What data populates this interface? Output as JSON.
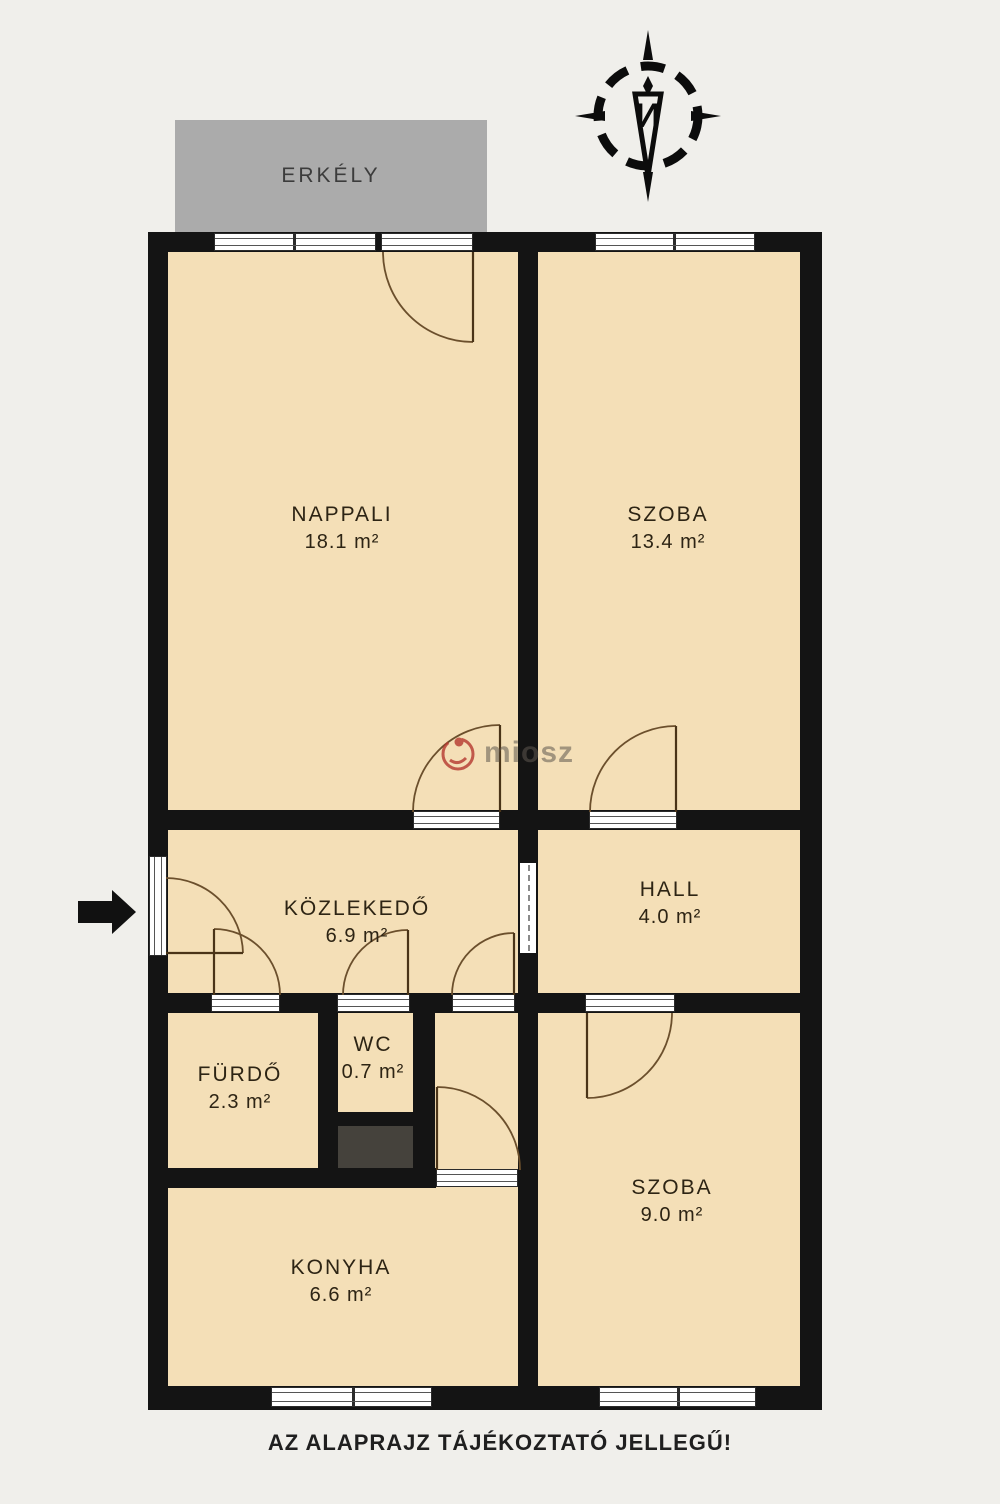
{
  "plan": {
    "balcony_label": "ERKÉLY",
    "disclaimer": "AZ ALAPRAJZ TÁJÉKOZTATÓ JELLEGŰ!",
    "watermark": "miosz",
    "compass_letter": "И",
    "rooms": [
      {
        "name": "NAPPALI",
        "area": "18.1 m²"
      },
      {
        "name": "SZOBA",
        "area": "13.4 m²"
      },
      {
        "name": "KÖZLEKEDŐ",
        "area": "6.9 m²"
      },
      {
        "name": "HALL",
        "area": "4.0 m²"
      },
      {
        "name": "FÜRDŐ",
        "area": "2.3 m²"
      },
      {
        "name": "WC",
        "area": "0.7 m²"
      },
      {
        "name": "KONYHA",
        "area": "6.6 m²"
      },
      {
        "name": "SZOBA",
        "area": "9.0 m²"
      }
    ],
    "colors": {
      "background": "#f0efeb",
      "room_fill": "#f4dfb7",
      "wall": "#141414",
      "balcony": "#ababab",
      "shaft": "#45423c",
      "door_arc": "#6b4f2c",
      "watermark_red": "#b5382f"
    }
  }
}
